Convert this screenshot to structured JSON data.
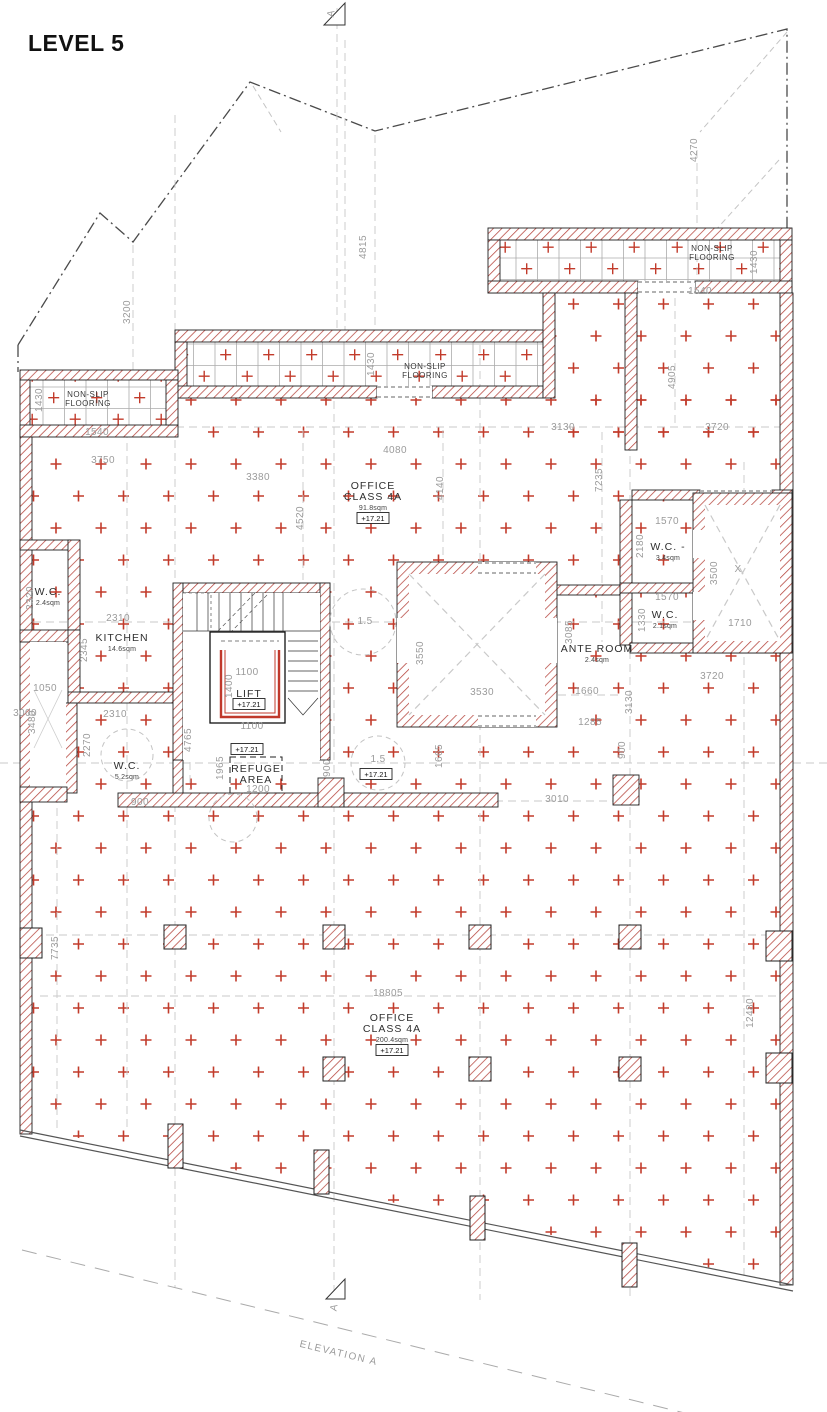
{
  "title": "LEVEL 5",
  "level_text": "+17.21",
  "elevation_marker": "A",
  "elevation_line_label": "ELEVATION A",
  "colors": {
    "cross": "#c23b2b",
    "wall_hatch": "#b5443c",
    "dim_text": "#9b9b9b",
    "ink": "#2a2a2a"
  },
  "nonslip": [
    {
      "l1": "NON-SLIP",
      "l2": "FLOORING",
      "x": 712,
      "y": 251
    },
    {
      "l1": "NON-SLIP",
      "l2": "FLOORING",
      "x": 425,
      "y": 369
    },
    {
      "l1": "NON-SLIP",
      "l2": "FLOORING",
      "x": 88,
      "y": 397
    }
  ],
  "rooms": [
    {
      "lines": [
        "OFFICE",
        "CLASS 4A"
      ],
      "area": "91.8sqm",
      "x": 373,
      "y": 489
    },
    {
      "lines": [
        "OFFICE",
        "CLASS 4A"
      ],
      "area": "200.4sqm",
      "x": 392,
      "y": 1021
    },
    {
      "lines": [
        "KITCHEN"
      ],
      "area": "14.6sqm",
      "x": 122,
      "y": 641
    },
    {
      "lines": [
        "W.C."
      ],
      "area": "2.4sqm",
      "x": 48,
      "y": 595
    },
    {
      "lines": [
        "W.C."
      ],
      "area": "5.2sqm",
      "x": 127,
      "y": 769
    },
    {
      "lines": [
        "W.C. -"
      ],
      "area": "3.4sqm",
      "x": 668,
      "y": 550
    },
    {
      "lines": [
        "W.C."
      ],
      "area": "2.1sqm",
      "x": 665,
      "y": 618
    },
    {
      "lines": [
        "ANTE ROOM"
      ],
      "area": "2.4sqm",
      "x": 597,
      "y": 652
    },
    {
      "lines": [
        "REFUGE",
        "AREA"
      ],
      "x": 256,
      "y": 772
    },
    {
      "lines": [
        "LIFT"
      ],
      "x": 249,
      "y": 697
    }
  ],
  "level_boxes": [
    {
      "x": 373,
      "y": 521
    },
    {
      "x": 392,
      "y": 1053
    },
    {
      "x": 249,
      "y": 707
    },
    {
      "x": 247,
      "y": 752
    },
    {
      "x": 376,
      "y": 777
    }
  ],
  "dimensions": [
    {
      "t": "4815",
      "x": 366,
      "y": 247,
      "r": -90
    },
    {
      "t": "4270",
      "x": 697,
      "y": 150,
      "r": -90
    },
    {
      "t": "3200",
      "x": 130,
      "y": 312,
      "r": -90
    },
    {
      "t": "1430",
      "x": 757,
      "y": 262,
      "r": -90
    },
    {
      "t": "1540",
      "x": 700,
      "y": 294
    },
    {
      "t": "1430",
      "x": 374,
      "y": 364,
      "r": -90
    },
    {
      "t": "1430",
      "x": 42,
      "y": 400,
      "r": -90
    },
    {
      "t": "1540",
      "x": 97,
      "y": 435
    },
    {
      "t": "3750",
      "x": 103,
      "y": 463
    },
    {
      "t": "3380",
      "x": 258,
      "y": 480
    },
    {
      "t": "4080",
      "x": 395,
      "y": 453
    },
    {
      "t": "3130",
      "x": 563,
      "y": 430
    },
    {
      "t": "3720",
      "x": 717,
      "y": 430
    },
    {
      "t": "4905",
      "x": 675,
      "y": 377,
      "r": -90
    },
    {
      "t": "7235",
      "x": 602,
      "y": 480,
      "r": -90
    },
    {
      "t": "4520",
      "x": 303,
      "y": 518,
      "r": -90
    },
    {
      "t": "4140",
      "x": 443,
      "y": 488,
      "r": -90
    },
    {
      "t": "2320",
      "x": 33,
      "y": 598,
      "r": -90
    },
    {
      "t": "2310",
      "x": 118,
      "y": 621
    },
    {
      "t": "2345",
      "x": 87,
      "y": 650,
      "r": -90
    },
    {
      "t": "1050",
      "x": 45,
      "y": 691
    },
    {
      "t": "3000",
      "x": 25,
      "y": 716
    },
    {
      "t": "2310",
      "x": 115,
      "y": 717
    },
    {
      "t": "3480",
      "x": 35,
      "y": 722,
      "r": -90
    },
    {
      "t": "2270",
      "x": 90,
      "y": 745,
      "r": -90
    },
    {
      "t": "900",
      "x": 140,
      "y": 805
    },
    {
      "t": "1570",
      "x": 667,
      "y": 524
    },
    {
      "t": "2180",
      "x": 643,
      "y": 546,
      "r": -90
    },
    {
      "t": "1570",
      "x": 667,
      "y": 600
    },
    {
      "t": "1330",
      "x": 645,
      "y": 620,
      "r": -90
    },
    {
      "t": "3500",
      "x": 717,
      "y": 573,
      "r": -90
    },
    {
      "t": "1710",
      "x": 740,
      "y": 626
    },
    {
      "t": "X",
      "x": 738,
      "y": 572
    },
    {
      "t": "3085",
      "x": 572,
      "y": 632,
      "r": -90
    },
    {
      "t": "3720",
      "x": 712,
      "y": 679
    },
    {
      "t": "1660",
      "x": 587,
      "y": 694
    },
    {
      "t": "1285",
      "x": 590,
      "y": 725
    },
    {
      "t": "3130",
      "x": 632,
      "y": 702,
      "r": -90
    },
    {
      "t": "3550",
      "x": 423,
      "y": 653,
      "r": -90
    },
    {
      "t": "3530",
      "x": 482,
      "y": 695
    },
    {
      "t": "1.5",
      "x": 365,
      "y": 624
    },
    {
      "t": "1.5",
      "x": 378,
      "y": 762
    },
    {
      "t": "1100",
      "x": 247,
      "y": 675
    },
    {
      "t": "1400",
      "x": 232,
      "y": 686,
      "r": -90
    },
    {
      "t": "1100",
      "x": 252,
      "y": 729
    },
    {
      "t": "4765",
      "x": 191,
      "y": 740,
      "r": -90
    },
    {
      "t": "1965",
      "x": 223,
      "y": 768,
      "r": -90
    },
    {
      "t": "900",
      "x": 330,
      "y": 768,
      "r": -90
    },
    {
      "t": "1200",
      "x": 258,
      "y": 792
    },
    {
      "t": "1665",
      "x": 442,
      "y": 756,
      "r": -90
    },
    {
      "t": "3010",
      "x": 557,
      "y": 802
    },
    {
      "t": "900",
      "x": 625,
      "y": 750,
      "r": -90
    },
    {
      "t": "7735",
      "x": 58,
      "y": 948,
      "r": -90
    },
    {
      "t": "18805",
      "x": 388,
      "y": 996
    },
    {
      "t": "12480",
      "x": 753,
      "y": 1013,
      "r": -90
    }
  ]
}
